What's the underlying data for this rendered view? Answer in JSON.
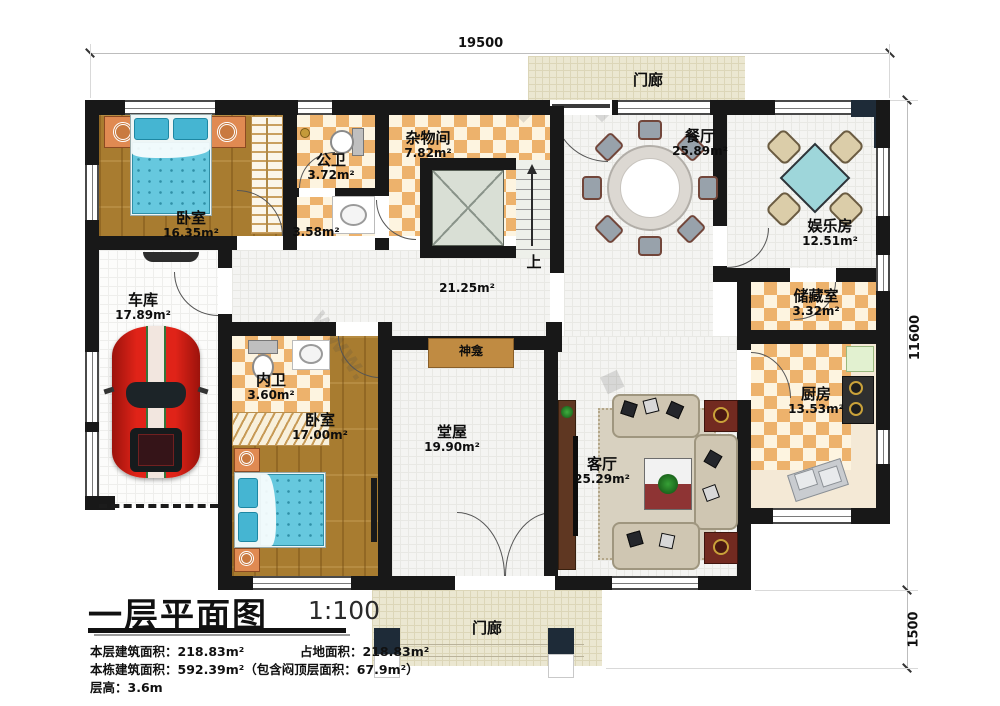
{
  "dims": {
    "top": "19500",
    "right": "11600",
    "right_lower": "1500"
  },
  "rooms": {
    "bedroom1": {
      "label": "卧室",
      "area": "16.35m²"
    },
    "garage": {
      "label": "车库",
      "area": "17.89m²"
    },
    "bath_public": {
      "label": "公卫",
      "area": "3.72m²",
      "area2": "3.58m²"
    },
    "utility": {
      "label": "杂物间",
      "area": "7.82m²"
    },
    "corridor": {
      "area": "21.25m²"
    },
    "stairs": {
      "up_label": "上"
    },
    "dining": {
      "label": "餐厅",
      "area": "25.89m²"
    },
    "entertainment": {
      "label": "娱乐房",
      "area": "12.51m²"
    },
    "storage": {
      "label": "储藏室",
      "area": "3.32m²"
    },
    "kitchen": {
      "label": "厨房",
      "area": "13.53m²"
    },
    "living": {
      "label": "客厅",
      "area": "25.29m²"
    },
    "hall": {
      "label": "堂屋",
      "area": "19.90m²"
    },
    "bedroom2": {
      "label": "卧室",
      "area": "17.00m²"
    },
    "bath_inner": {
      "label": "内卫",
      "area": "3.60m²"
    },
    "porch_top": {
      "label": "门廊"
    },
    "porch_bottom": {
      "label": "门廊"
    },
    "shrine": {
      "label": "神龛"
    }
  },
  "title_block": {
    "title": "一层平面图",
    "scale": "1:100",
    "line1a": "本层建筑面积：218.83m²",
    "line1b": "占地面积：218.83m²",
    "line2": "本栋建筑面积：592.39m²（包含闷顶层面积：67.9m²）",
    "line3": "层高：3.6m"
  },
  "watermark": {
    "text": "www.",
    "diamond": "◆"
  }
}
